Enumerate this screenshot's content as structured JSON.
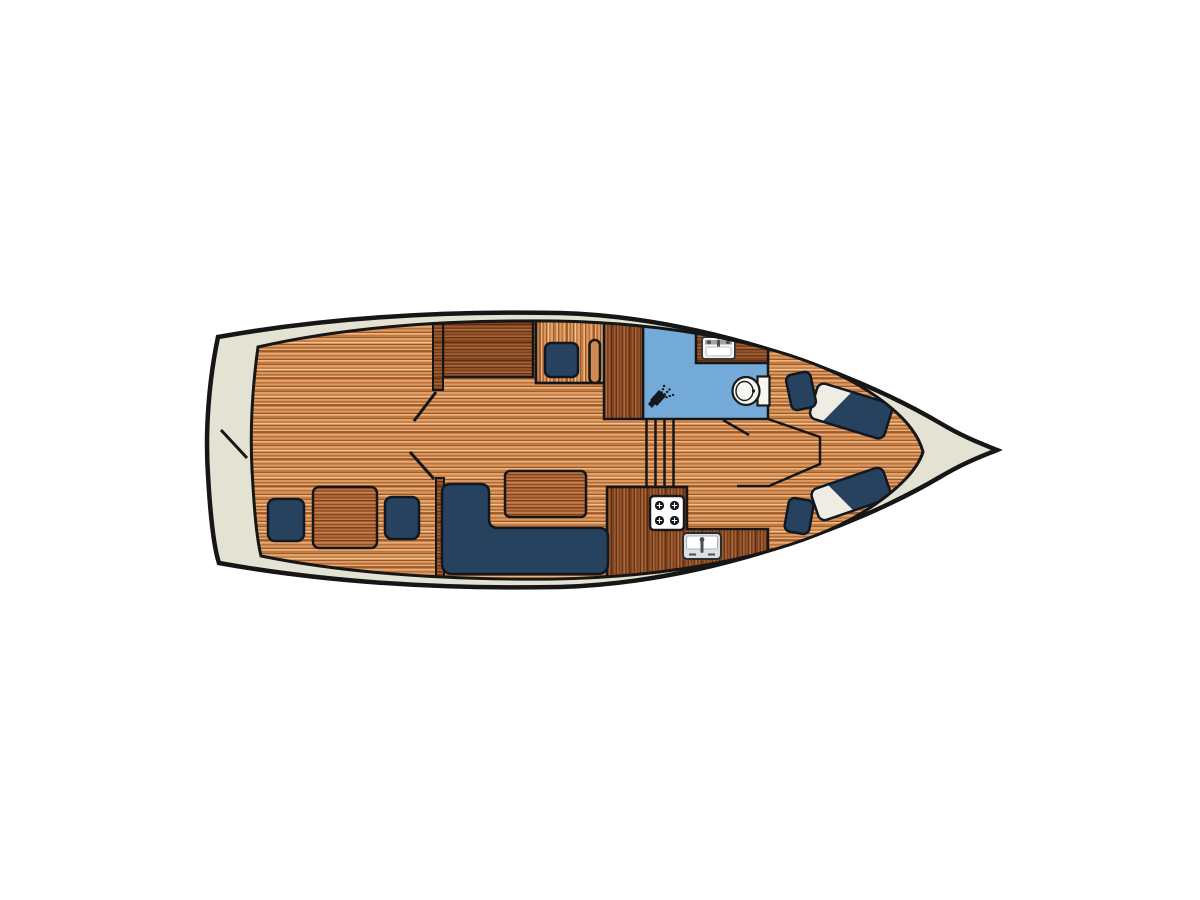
{
  "page": {
    "background": "#FFFFFF"
  },
  "floor_plan": {
    "subject": "motor-yacht-interior-top-view",
    "orientation": "bow-right-stern-left",
    "areas": [
      {
        "name": "aft-cockpit",
        "items": [
          "seat-cushion",
          "cockpit-table",
          "seat-cushion",
          "mooring-line"
        ]
      },
      {
        "name": "saloon",
        "items": [
          "l-shaped-sofa",
          "saloon-table",
          "sideboard-panel",
          "seat-cushion",
          "door-handle"
        ]
      },
      {
        "name": "wardrobe",
        "items": [
          "cabinet"
        ]
      },
      {
        "name": "bathroom",
        "items": [
          "shower-icon",
          "washbasin-icon",
          "toilet-icon",
          "door-swing"
        ]
      },
      {
        "name": "galley",
        "items": [
          "stove-icon",
          "sink-icon",
          "counter"
        ]
      },
      {
        "name": "companionway",
        "items": [
          "steps"
        ]
      },
      {
        "name": "bow-cabin",
        "items": [
          "single-bed-with-pillow",
          "single-bed-with-pillow",
          "side-table",
          "side-table"
        ]
      }
    ],
    "colors": {
      "hull_deck": "#E4E2D3",
      "outline": "#161616",
      "wood_light": "#CE8A52",
      "wood_medium": "#A86034",
      "wood_dark": "#8A4A26",
      "upholstery_navy": "#26425F",
      "bathroom_blue": "#74AAD8",
      "pillow_white": "#EFEDE3",
      "fixture_white": "#F7F6F1"
    }
  }
}
